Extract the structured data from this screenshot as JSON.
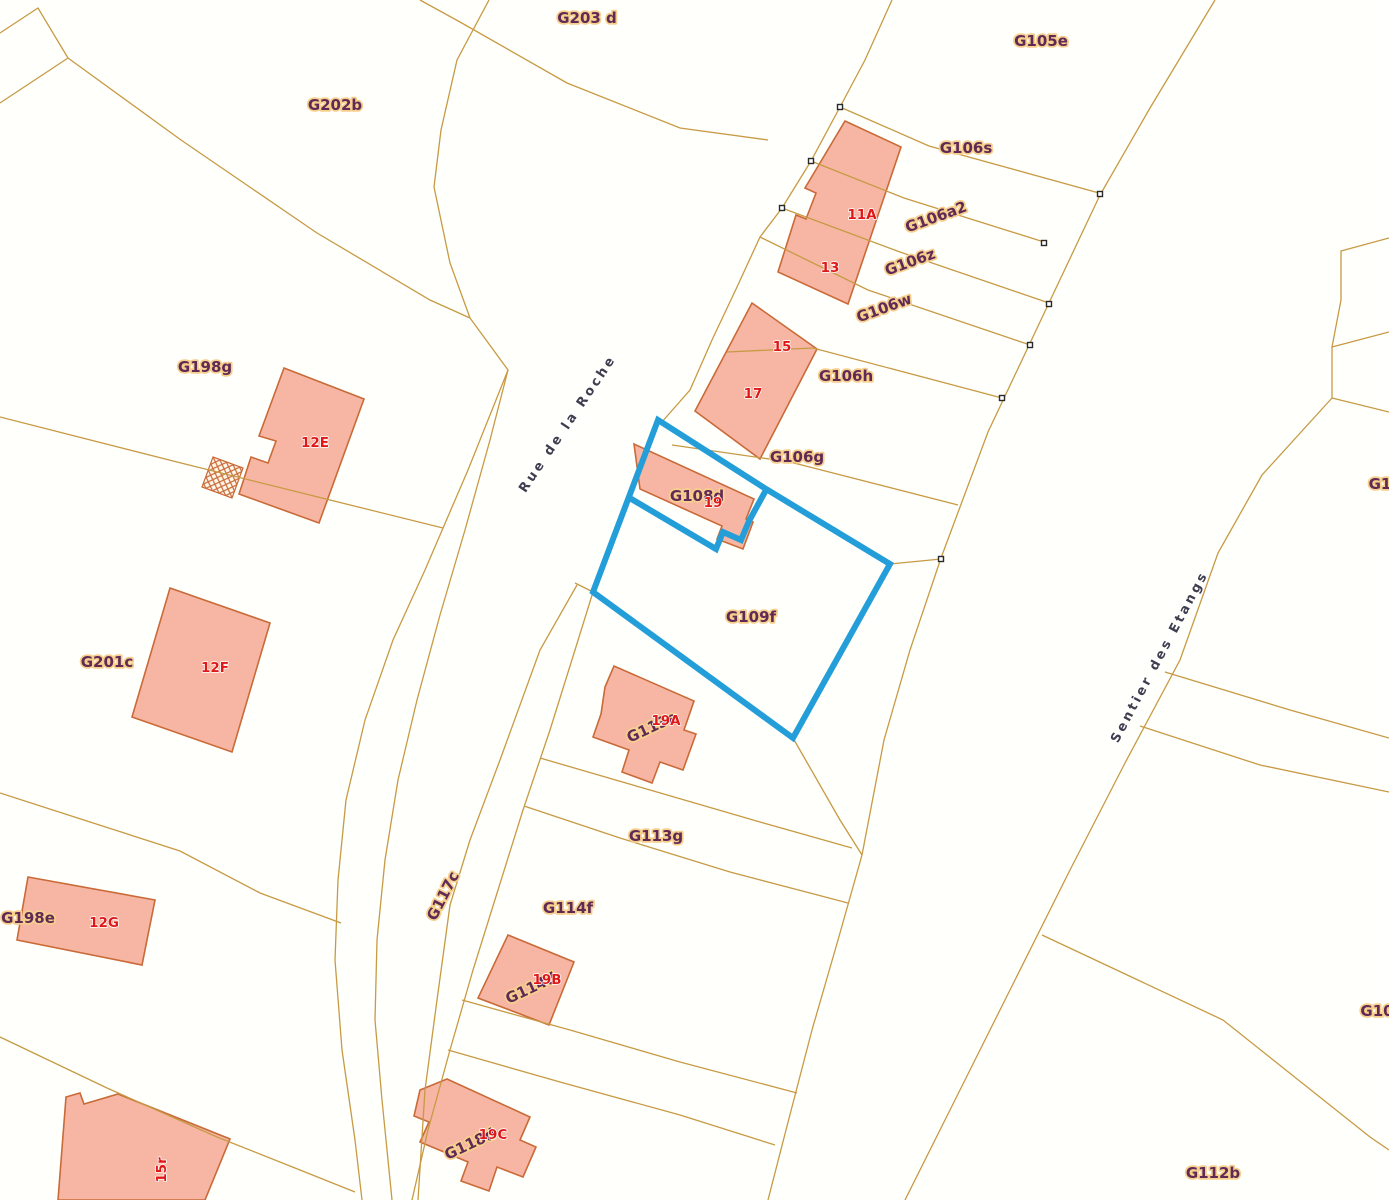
{
  "map": {
    "title": "cadastral-parcel-map",
    "width": 1389,
    "height": 1200,
    "colors": {
      "background": "#fffffc",
      "boundary": "#c79a44",
      "building_fill": "#f7b6a3",
      "building_stroke": "#c96a38",
      "selection": "#239ed9",
      "parcel_label": "#5f2a55",
      "parcel_halo": "#f7cf8d",
      "house_number": "#e01717",
      "street_label": "#3e3e4e",
      "marker": "#2a2a2a"
    },
    "boundaries": [
      "0,33 38,8 68,58",
      "68,58 0,103",
      "68,58 181,140 317,233 430,300 470,318",
      "489,0 457,60 441,130 434,187 450,263 470,318",
      "470,318 508,370 468,470 425,570 393,640 365,720 346,800 338,880 335,960 342,1050 355,1140 362,1200",
      "508,370 490,440 465,530 440,615 417,700 398,780 385,860 377,940 375,1020 382,1100 390,1180 392,1200",
      "420,0 460,22 567,83 680,128 768,140",
      "892,0 865,60 840,107 811,161 782,208 760,237 737,287 712,340 690,390 661,423",
      "1215,0 1150,108 1100,195 1048,305 988,432 941,558 910,650 884,740 862,855 838,940 812,1030 786,1130 768,1200",
      "1332,398 1262,475 1218,553 1180,660 1125,763 1070,870 1015,980 955,1100 905,1200",
      "1389,332 1332,347 1332,398 1389,412",
      "1389,238 1341,251 1341,300 1332,347",
      "1165,672 1290,710 1389,738",
      "1140,726 1260,765 1389,792",
      "1042,935 1223,1020 1370,1137 1389,1150",
      "840,107 929,146 1099,193",
      "811,161 904,198 1044,242",
      "782,208 900,252 1049,303",
      "760,237 868,290 1030,345",
      "727,352 813,348 1002,398",
      "672,445 790,462 958,505",
      "890,564 941,559",
      "793,738 840,820 862,855",
      "593,592 575,650 550,730 523,810 498,890 473,970 450,1050 428,1130 412,1200",
      "577,585 540,650 500,760 470,840 450,905 437,1000 425,1090 418,1200",
      "575,583 593,592",
      "540,758 650,790 760,822 852,848",
      "524,806 620,838 730,872 848,903",
      "462,1000 570,1030 680,1062 797,1093",
      "448,1050 560,1082 680,1115 775,1145",
      "0,417 181,463 330,500 443,528",
      "0,793 90,822 180,851 260,893 341,923",
      "0,1037 107,1088 217,1137 300,1170 355,1192"
    ],
    "buildings": [
      "845,121 901,147 848,304 778,272 796,215 806,219 816,193 805,188",
      "752,303 817,349 760,459 695,411",
      "634,444 754,499 746,519 753,522 743,549 717,539 722,526 640,489",
      "284,368 364,399 319,523 239,494 251,457 268,463 276,441 259,436",
      "170,588 270,623 232,752 132,717",
      "28,877 155,900 142,965 17,940",
      "66,1097 80,1093 84,1104 118,1094 230,1139 205,1200 58,1200",
      "605,687 614,666 694,701 684,730 696,734 683,770 660,762 652,783 622,772 629,750 593,737 601,714",
      "508,935 574,962 549,1025 478,998",
      "420,1090 447,1079 530,1117 520,1140 536,1147 523,1177 497,1167 489,1191 461,1181 468,1162 420,1142 429,1122 414,1116"
    ],
    "hatched_annexes": [
      "213,457 243,468 232,498 202,487"
    ],
    "selection": {
      "selected_parcels": [
        "G108d",
        "G109f"
      ],
      "outer": "658,420 766,489 890,564 793,738 593,592",
      "divider": "628,497 716,549 723,532 741,540 749,521 766,490"
    },
    "survey_markers": [
      [
        840,
        107
      ],
      [
        811,
        161
      ],
      [
        782,
        208
      ],
      [
        1100,
        194
      ],
      [
        1044,
        243
      ],
      [
        1049,
        304
      ],
      [
        1030,
        345
      ],
      [
        1002,
        398
      ],
      [
        941,
        559
      ]
    ],
    "labels": [
      {
        "text": "G203 d",
        "x": 587,
        "y": 18,
        "kind": "parcel"
      },
      {
        "text": "G202b",
        "x": 335,
        "y": 105,
        "kind": "parcel"
      },
      {
        "text": "G105e",
        "x": 1041,
        "y": 41,
        "kind": "parcel"
      },
      {
        "text": "G106s",
        "x": 966,
        "y": 148,
        "kind": "parcel"
      },
      {
        "text": "G106a2",
        "x": 936,
        "y": 217,
        "kind": "parcel",
        "rot": -20
      },
      {
        "text": "G106z",
        "x": 910,
        "y": 262,
        "kind": "parcel",
        "rot": -20
      },
      {
        "text": "G106w",
        "x": 884,
        "y": 308,
        "kind": "parcel",
        "rot": -20
      },
      {
        "text": "G106h",
        "x": 846,
        "y": 376,
        "kind": "parcel"
      },
      {
        "text": "G106g",
        "x": 797,
        "y": 457,
        "kind": "parcel"
      },
      {
        "text": "G108d",
        "x": 697,
        "y": 496,
        "kind": "parcel"
      },
      {
        "text": "G109f",
        "x": 751,
        "y": 617,
        "kind": "parcel"
      },
      {
        "text": "G198g",
        "x": 205,
        "y": 367,
        "kind": "parcel"
      },
      {
        "text": "G201c",
        "x": 107,
        "y": 662,
        "kind": "parcel"
      },
      {
        "text": "G198e",
        "x": 28,
        "y": 918,
        "kind": "parcel"
      },
      {
        "text": "G113e",
        "x": 652,
        "y": 727,
        "kind": "parcel",
        "rot": -25
      },
      {
        "text": "G113g",
        "x": 656,
        "y": 836,
        "kind": "parcel"
      },
      {
        "text": "G114f",
        "x": 568,
        "y": 908,
        "kind": "parcel"
      },
      {
        "text": "G114d",
        "x": 531,
        "y": 988,
        "kind": "parcel",
        "rot": -25
      },
      {
        "text": "G117c",
        "x": 443,
        "y": 896,
        "kind": "parcel",
        "rot": -63
      },
      {
        "text": "G118d",
        "x": 470,
        "y": 1144,
        "kind": "parcel",
        "rot": -25
      },
      {
        "text": "G112b",
        "x": 1213,
        "y": 1173,
        "kind": "parcel"
      },
      {
        "text": "G1",
        "x": 1380,
        "y": 484,
        "kind": "parcel"
      },
      {
        "text": "G10",
        "x": 1377,
        "y": 1011,
        "kind": "parcel"
      },
      {
        "text": "11A",
        "x": 862,
        "y": 215,
        "kind": "house"
      },
      {
        "text": "13",
        "x": 830,
        "y": 268,
        "kind": "house"
      },
      {
        "text": "15",
        "x": 782,
        "y": 347,
        "kind": "house"
      },
      {
        "text": "17",
        "x": 753,
        "y": 394,
        "kind": "house"
      },
      {
        "text": "19",
        "x": 713,
        "y": 503,
        "kind": "house"
      },
      {
        "text": "12E",
        "x": 315,
        "y": 443,
        "kind": "house"
      },
      {
        "text": "12F",
        "x": 215,
        "y": 668,
        "kind": "house"
      },
      {
        "text": "12G",
        "x": 104,
        "y": 923,
        "kind": "house"
      },
      {
        "text": "19A",
        "x": 666,
        "y": 721,
        "kind": "house"
      },
      {
        "text": "19B",
        "x": 547,
        "y": 980,
        "kind": "house"
      },
      {
        "text": "19C",
        "x": 493,
        "y": 1135,
        "kind": "house"
      },
      {
        "text": "15r",
        "x": 162,
        "y": 1170,
        "kind": "house",
        "rot": -90
      },
      {
        "text": "Rue de la Roche",
        "x": 568,
        "y": 424,
        "kind": "street",
        "rot": -56
      },
      {
        "text": "Sentier des Etangs",
        "x": 1160,
        "y": 657,
        "kind": "street",
        "rot": -62
      }
    ]
  }
}
